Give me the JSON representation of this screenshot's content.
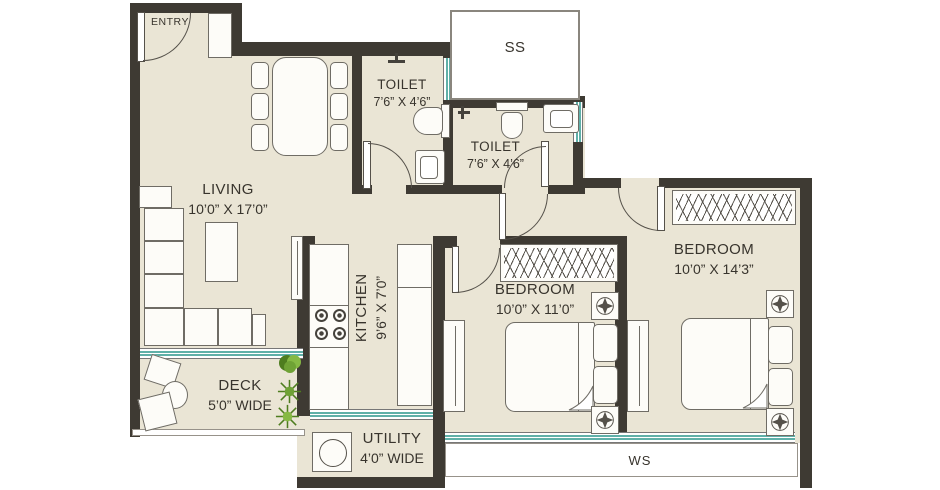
{
  "colors": {
    "wall": "#3e3a33",
    "floor": "#eae5d5",
    "win": "#5fb0a8",
    "text": "#38342d",
    "outline": "#6f6c65",
    "plant": "#6fa235"
  },
  "labels": {
    "entry": "ENTRY",
    "living": "LIVING",
    "living_dims": "10’0” X 17’0”",
    "toilet1": "TOILET",
    "toilet1_dims": "7’6” X 4’6”",
    "toilet2": "TOILET",
    "toilet2_dims": "7’6” X 4’6”",
    "ss": "SS",
    "kitchen": "KITCHEN",
    "kitchen_dims": "9’6” X 7’0”",
    "utility": "UTILITY",
    "utility_dims": "4’0” WIDE",
    "deck": "DECK",
    "deck_dims": "5’0” WIDE",
    "bedroom1": "BEDROOM",
    "bedroom1_dims": "10’0” X 11’0”",
    "bedroom2": "BEDROOM",
    "bedroom2_dims": "10’0” X 14’3”",
    "ws": "WS"
  }
}
